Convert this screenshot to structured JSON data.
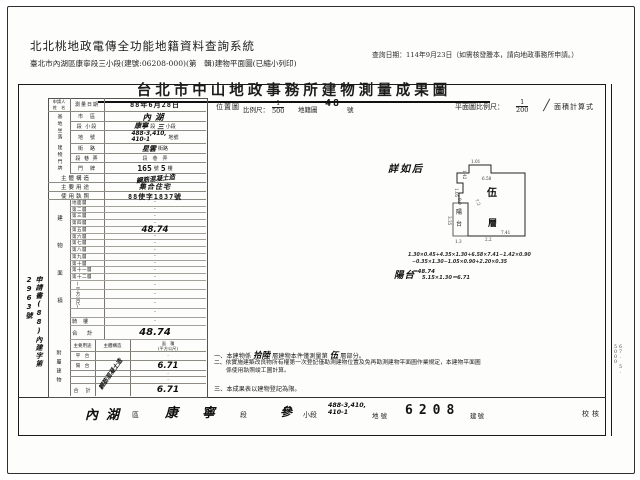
{
  "colors": {
    "ink": "#1c1c1c",
    "paper": "#fcfcfa",
    "frame": "#1a1a1a"
  },
  "header": {
    "system_title": "北北桃地政電傳全功能地籍資料查詢系統",
    "query_date": "查詢日期：114年9月23日（如需核發謄本，請向地政事務所申請。）",
    "subtitle": "臺北市內湖區康寧段三小段(建號:06208-000)(第　輯)建物平面圖(已縮小列印)"
  },
  "doc": {
    "title": "台北市中山地政事務所建物測量成果圖",
    "location_map": {
      "label": "位置圖",
      "scale_label": "比例尺：",
      "num": "1",
      "den": "500",
      "cadastre_label": "地籍圖",
      "cadastre_no": "48",
      "no_suffix": "號",
      "see_note": "詳如后"
    },
    "plan_scale": {
      "label": "平面圖比例尺：",
      "num": "1",
      "den": "200",
      "calc_label": "面積計算式"
    },
    "applicant": {
      "label_line1": "申請人",
      "label_line2": "姓　名",
      "stamp": "申請書(88)內建字第2963號"
    },
    "survey": {
      "label": "測量日期",
      "value": "88年6月28日"
    },
    "site": {
      "group": "基地坐落",
      "district": {
        "label": "市　區",
        "value": "內湖"
      },
      "section": {
        "label": "段 小段",
        "hw1": "康寧",
        "p1": "段",
        "hw2": "三",
        "p2": "小段"
      },
      "lot": {
        "label": "地　號",
        "hw1": "488-3,410,",
        "hw2": "410-1",
        "suffix": "地號"
      }
    },
    "bldg": {
      "group": "建物門牌",
      "street": {
        "label": "街　路",
        "hw1": "星雲",
        "p1": "街路"
      },
      "lane": {
        "label": "段 巷 弄",
        "value": "段　巷　弄"
      },
      "number": {
        "label": "門　牌",
        "hw1": "165",
        "p1": "號",
        "hw2": "5",
        "p2": "樓"
      }
    },
    "structure": {
      "label": "主體構造",
      "value": "鋼筋混凝土造"
    },
    "usage": {
      "label": "主要用途",
      "value": "集合住宅"
    },
    "license": {
      "label": "使用執照",
      "value": "88使字1837號"
    },
    "floor_area": {
      "group": "建物面積",
      "unit": "(平方公尺)",
      "rows": [
        {
          "label": "地面層",
          "value": "·"
        },
        {
          "label": "第二層",
          "value": "·"
        },
        {
          "label": "第三層",
          "value": "·"
        },
        {
          "label": "第四層",
          "value": "·"
        },
        {
          "label": "第五層",
          "value": "48.74"
        },
        {
          "label": "第六層",
          "value": "·"
        },
        {
          "label": "第七層",
          "value": "·"
        },
        {
          "label": "第八層",
          "value": "·"
        },
        {
          "label": "第九層",
          "value": "·"
        },
        {
          "label": "第十層",
          "value": "·"
        },
        {
          "label": "第十一層",
          "value": "·"
        },
        {
          "label": "第十二層",
          "value": "·"
        },
        {
          "label": "",
          "value": "·"
        },
        {
          "label": "",
          "value": "·"
        },
        {
          "label": "",
          "value": "·"
        },
        {
          "label": "",
          "value": "·"
        },
        {
          "label": "騎　樓",
          "value": "·"
        },
        {
          "label": "合　計",
          "value": "48.74"
        }
      ]
    },
    "annex": {
      "group": "附屬建物",
      "h1": "主要用途",
      "h2": "主體構造",
      "h3": "面　積",
      "h3b": "(平方公尺)",
      "diagonal": "鋼筋混凝土造",
      "rows": [
        {
          "use": "平　台",
          "area": "·"
        },
        {
          "use": "陽　台",
          "area": "6.71"
        },
        {
          "use": "",
          "area": "·"
        },
        {
          "use": "",
          "area": "·"
        },
        {
          "use": "合　計",
          "area": "6.71"
        }
      ]
    },
    "notes": {
      "n1": {
        "no": "一、",
        "a": "本建物係",
        "hw1": "拾陸",
        "b": "層建物本件僅測量第",
        "hw2": "伍",
        "c": "層部分。"
      },
      "n2": "二、依實施建築改良物所有權第一次登記僅勘測建物位置及免再勘測建物平面圖作業規定，本建物平面圖係使用執照竣工圖計算。",
      "n3": "三、本成果表以建物登記為限。"
    },
    "plan": {
      "floor_char": "伍",
      "storey_char": "層",
      "balcony_c1": "陽",
      "balcony_c2": "台",
      "dims": {
        "d1": "1.01",
        "d2": "1.42",
        "d3": "6.58",
        "d4": "7.2",
        "d5": "7.41",
        "d6": "2.2",
        "d7": "1.05",
        "d8": "0.9",
        "d9": "3.35",
        "d10": "1.3"
      },
      "f1": "1.30×0.45+4.35×1.30+6.58×7.41−1.42×0.90",
      "f2": "−0.35×1.30−1.05×0.90+2.20×0.35",
      "f3": "＝48.74",
      "f4": "5.15×1.30＝6.71",
      "f_balcony": "陽台"
    },
    "footer": {
      "district": "內湖",
      "d_suffix": "區",
      "section": "康寧",
      "s_suffix": "段",
      "sub": "參",
      "sub_suffix": "小段",
      "lot1": "488-3,410,",
      "lot2": "410-1",
      "lot_suffix": "地號",
      "bno": "6208",
      "bno_suffix": "建號",
      "check": "校核"
    },
    "side_code": "67. 5. 5000"
  }
}
